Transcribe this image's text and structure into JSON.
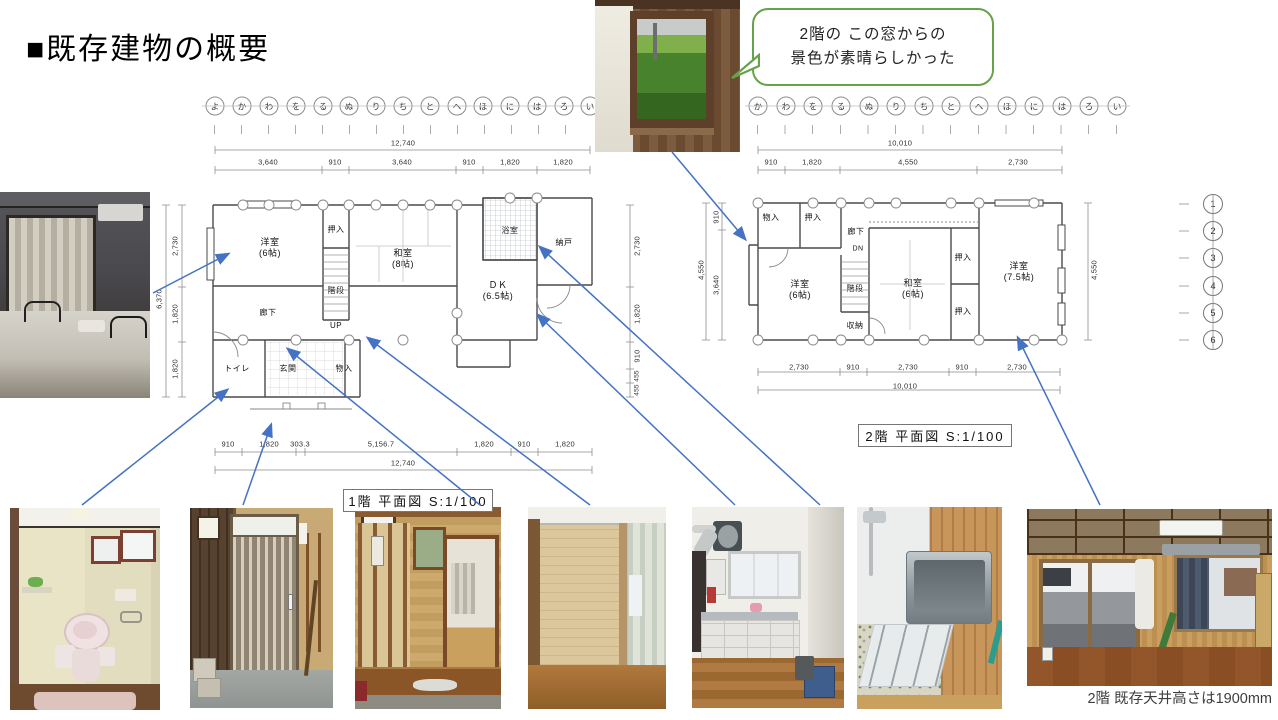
{
  "title": "■既存建物の概要",
  "callout": {
    "line1": "2階の この窓からの",
    "line2": "景色が素晴らしかった"
  },
  "bottom_caption": "2階 既存天井高さは1900mm",
  "plan1f": {
    "caption": "1階 平面図 S:1/100",
    "grid_letters": [
      "よ",
      "か",
      "わ",
      "を",
      "る",
      "ぬ",
      "り",
      "ち",
      "と",
      "へ",
      "ほ",
      "に",
      "は",
      "ろ",
      "い"
    ],
    "dim_total_top": "12,740",
    "dims_top": [
      "3,640",
      "910",
      "3,640",
      "910",
      "1,820",
      "1,820"
    ],
    "dims_bottom": [
      "910",
      "1,820",
      "303.3",
      "5,156.7",
      "1,820",
      "910",
      "1,820"
    ],
    "dim_total_bottom": "12,740",
    "dim_total_left": "6,370",
    "dims_left": [
      "2,730",
      "1,820",
      "1,820"
    ],
    "dims_right": [
      "2,730",
      "1,820",
      "910",
      "455",
      "455"
    ],
    "rooms": {
      "yoshitsu6": "洋室\n(6帖)",
      "oshiire": "押入",
      "washitsu8": "和室\n(8帖)",
      "kaidan": "階段",
      "up": "UP",
      "yokushitsu": "浴室",
      "nando": "納戸",
      "dk": "ＤＫ\n(6.5帖)",
      "rouka": "廊下",
      "toire": "トイレ",
      "genkan": "玄関",
      "monoire": "物入"
    }
  },
  "plan2f": {
    "caption": "2階 平面図 S:1/100",
    "grid_letters": [
      "か",
      "わ",
      "を",
      "る",
      "ぬ",
      "り",
      "ち",
      "と",
      "へ",
      "ほ",
      "に",
      "は",
      "ろ",
      "い"
    ],
    "dim_total_top": "10,010",
    "dims_top": [
      "910",
      "1,820",
      "4,550",
      "2,730"
    ],
    "dims_bottom": [
      "2,730",
      "910",
      "2,730",
      "910",
      "2,730"
    ],
    "dim_total_bottom": "10,010",
    "dims_left": [
      "910",
      "3,640"
    ],
    "dim_total_left": "4,550",
    "dim_total_right": "4,550",
    "rooms": {
      "monoire": "物入",
      "oshiire_top": "押入",
      "rouka": "廊下",
      "dn": "DN",
      "kaidan": "階段",
      "shuno": "収納",
      "yoshitsu6": "洋室\n(6帖)",
      "washitsu6": "和室\n(6帖)",
      "oshiire_r1": "押入",
      "oshiire_r2": "押入",
      "yoshitsu75": "洋室\n(7.5帖)"
    }
  },
  "grid_numbers": [
    "1",
    "2",
    "3",
    "4",
    "5",
    "6"
  ]
}
